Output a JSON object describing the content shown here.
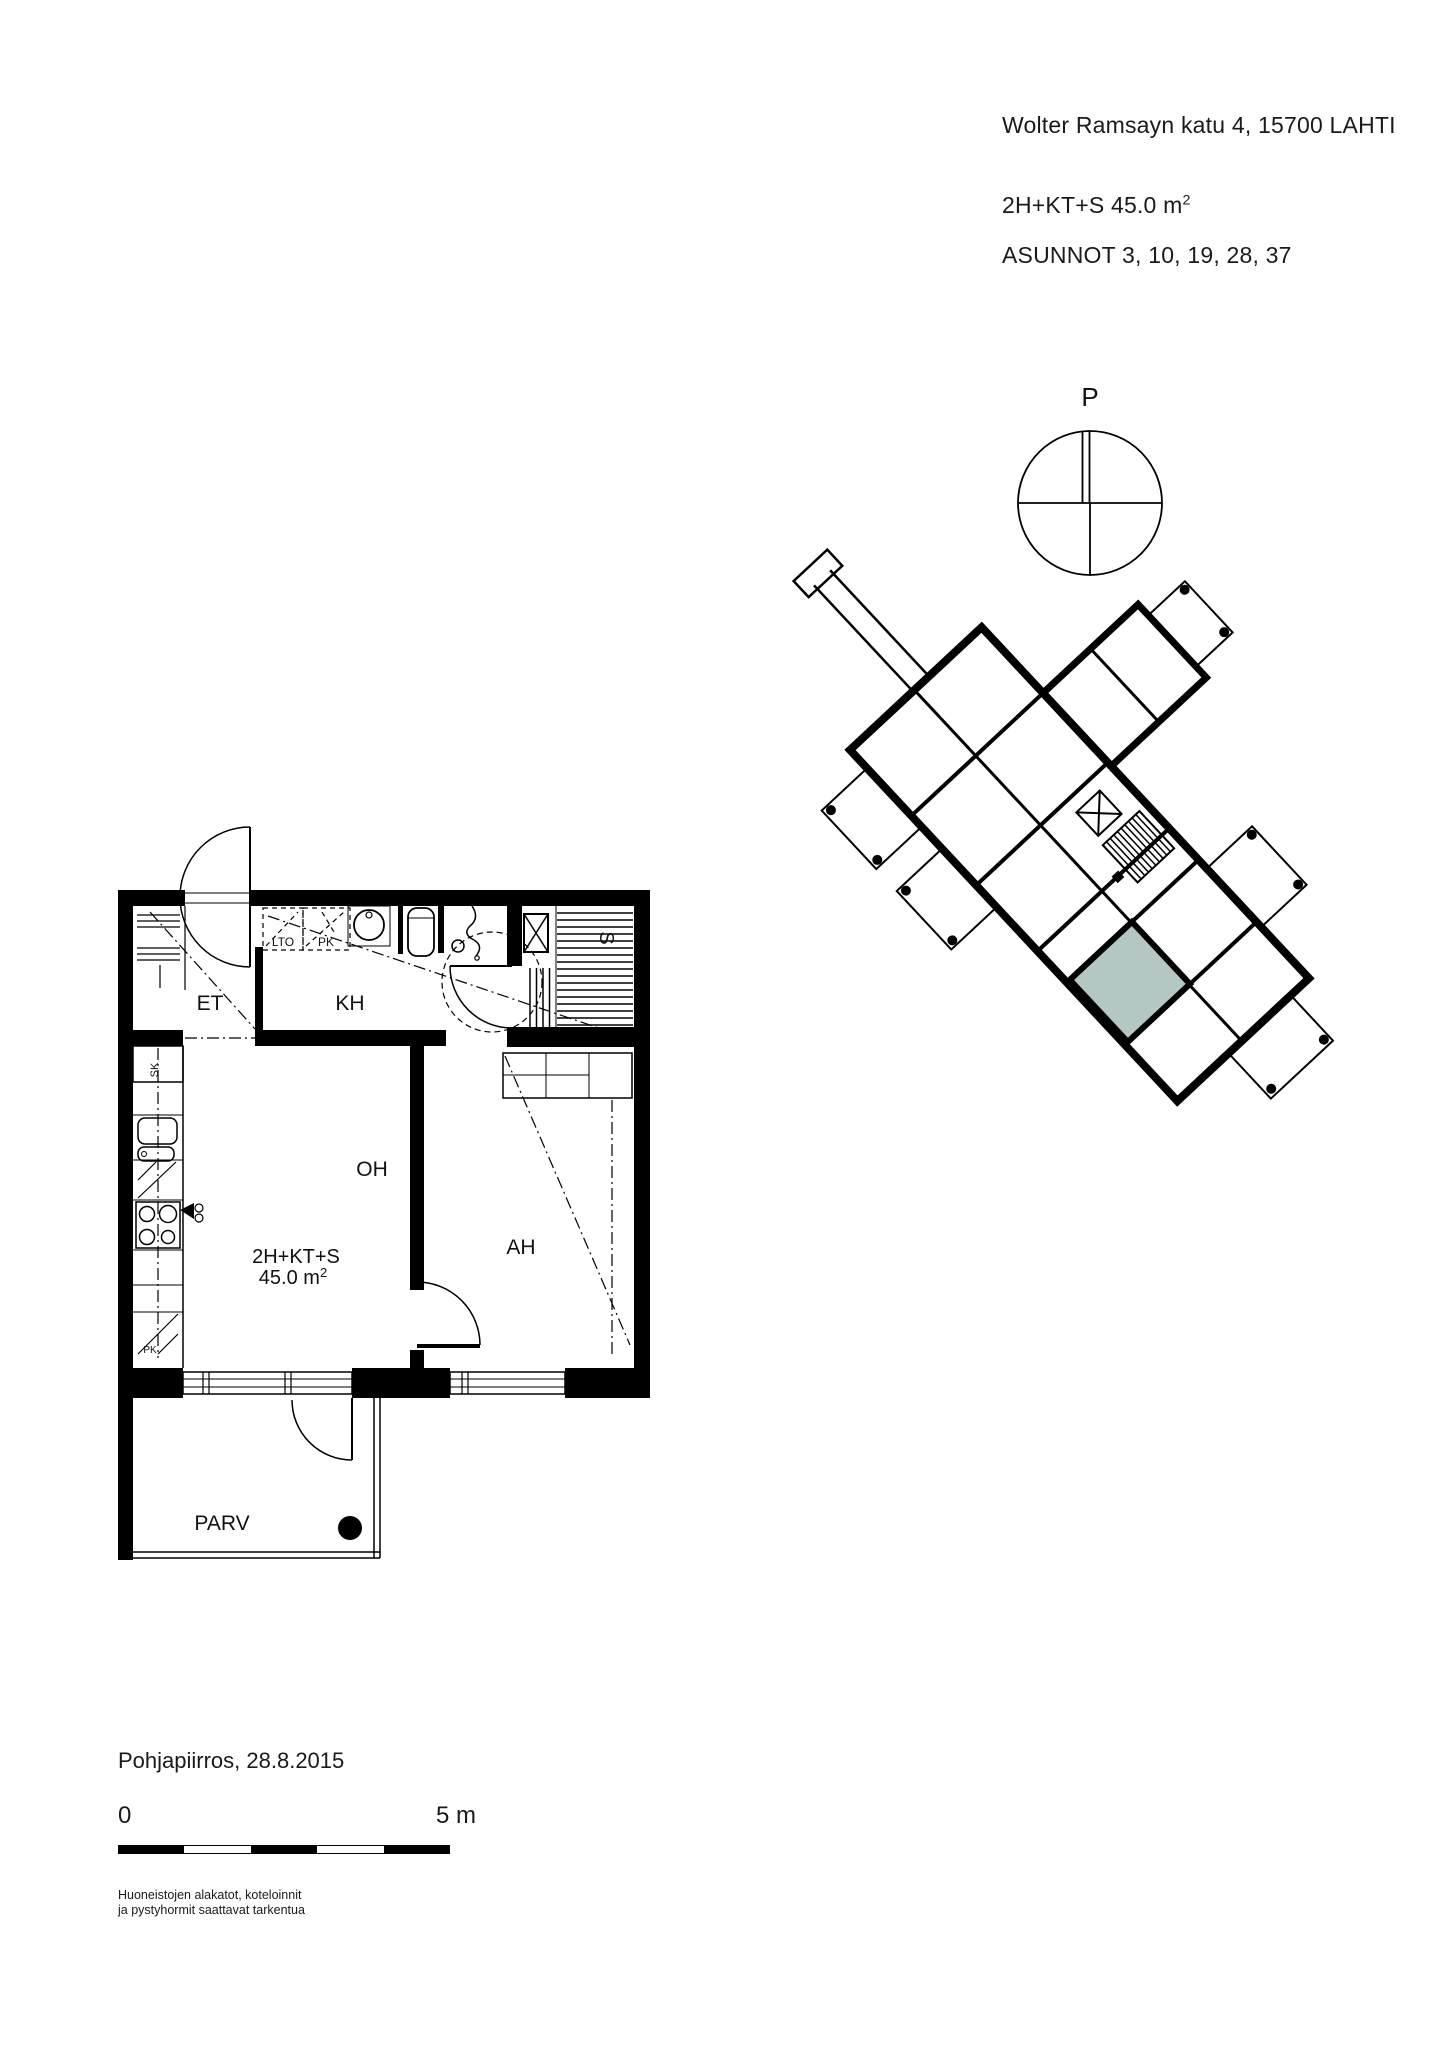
{
  "header": {
    "address": "Wolter Ramsayn katu 4, 15700 LAHTI",
    "apartment_type": "2H+KT+S 45.0 m",
    "apartment_type_sup": "2",
    "apartments": "ASUNNOT 3, 10, 19, 28, 37"
  },
  "compass": {
    "north_label": "P"
  },
  "site_plan": {
    "highlight_color": "#b4c7c3"
  },
  "floor_plan": {
    "rooms": {
      "entry": "ET",
      "bathroom": "KH",
      "living": "OH",
      "bedroom": "AH",
      "balcony": "PARV",
      "sauna": "S"
    },
    "closets": {
      "lto": "LTO",
      "pk": "PK",
      "sk": "SK",
      "pk_kitchen": "PK"
    },
    "area_label": {
      "line1": "2H+KT+S",
      "line2": "45.0 m",
      "sup": "2"
    }
  },
  "footer": {
    "drawing_title": "Pohjapiirros, 28.8.2015",
    "scale_start": "0",
    "scale_end": "5 m",
    "note_line1": "Huoneistojen alakatot, koteloinnit",
    "note_line2": "ja pystyhormit saattavat tarkentua"
  }
}
